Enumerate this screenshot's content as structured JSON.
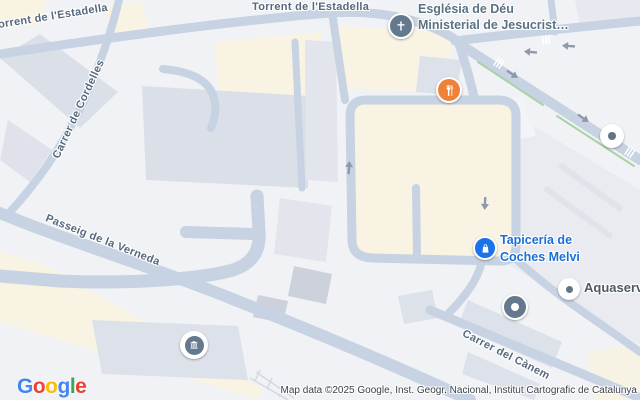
{
  "streets": {
    "torrent_rotated": "Torrent de l'Estadella",
    "torrent_horizontal": "Torrent de l'Estadella",
    "cordelles": "Carrer de Cordelles",
    "verneda": "Passeig de la Verneda",
    "canem": "Carrer del Cànem"
  },
  "pois": {
    "church": {
      "line1": "Església de Déu",
      "line2": "Ministerial de Jesucrist…",
      "icon": "church-cross-icon",
      "pin_color": "#64798E",
      "label_color": "#5B7282"
    },
    "fray": {
      "label": "Fray 83",
      "icon": "restaurant-fork-knife-icon",
      "pin_color": "#F08139",
      "label_color": "#E8710A"
    },
    "urbaser": {
      "label": "Urbaser",
      "icon": "generic-place-dot-icon",
      "pin_color": "#FFFFFF",
      "dot_color": "#5F7486",
      "label_color": "#4F5A64"
    },
    "tapiceria": {
      "line1": "Tapicería de",
      "line2": "Coches Melvi",
      "icon": "shopping-bag-icon",
      "pin_color": "#1A73E8",
      "label_color": "#1A6FD4"
    },
    "aquaserv": {
      "label": "Aquaserv",
      "icon": "generic-place-dot-icon",
      "pin_color": "#FFFFFF",
      "dot_color": "#5F7486",
      "label_color": "#4F5A64"
    },
    "poligon": {
      "line1": "Polígon industrial",
      "line2": "de Montsolís",
      "icon": "area-dot-icon",
      "pin_color": "#64798E",
      "label_color": "#5F6771"
    },
    "tmb": {
      "line1": "TMB Cotxeres",
      "line2": "Triangle Ferrioviari",
      "icon": "transit-depot-icon",
      "pin_color": "#64798E",
      "label_color": "#5F6771"
    }
  },
  "logo": {
    "letters": [
      {
        "ch": "G",
        "color": "#4285F4"
      },
      {
        "ch": "o",
        "color": "#EA4335"
      },
      {
        "ch": "o",
        "color": "#FBBC05"
      },
      {
        "ch": "g",
        "color": "#4285F4"
      },
      {
        "ch": "l",
        "color": "#34A853"
      },
      {
        "ch": "e",
        "color": "#EA4335"
      }
    ]
  },
  "attribution": {
    "text": "Map data ©2025 Google, Inst. Geogr. Nacional, Institut Cartografic de Catalunya"
  },
  "map_colors": {
    "background": "#F1F2F5",
    "road": "#C7D2E2",
    "building": "#DBDFE8",
    "building_dark": "#CCD1DB",
    "industrial_area": "#F8F3E2",
    "cycle_path_green": "#A9D3A4",
    "one_way_arrow": "#8E99A9",
    "street_label": "#56687E"
  }
}
